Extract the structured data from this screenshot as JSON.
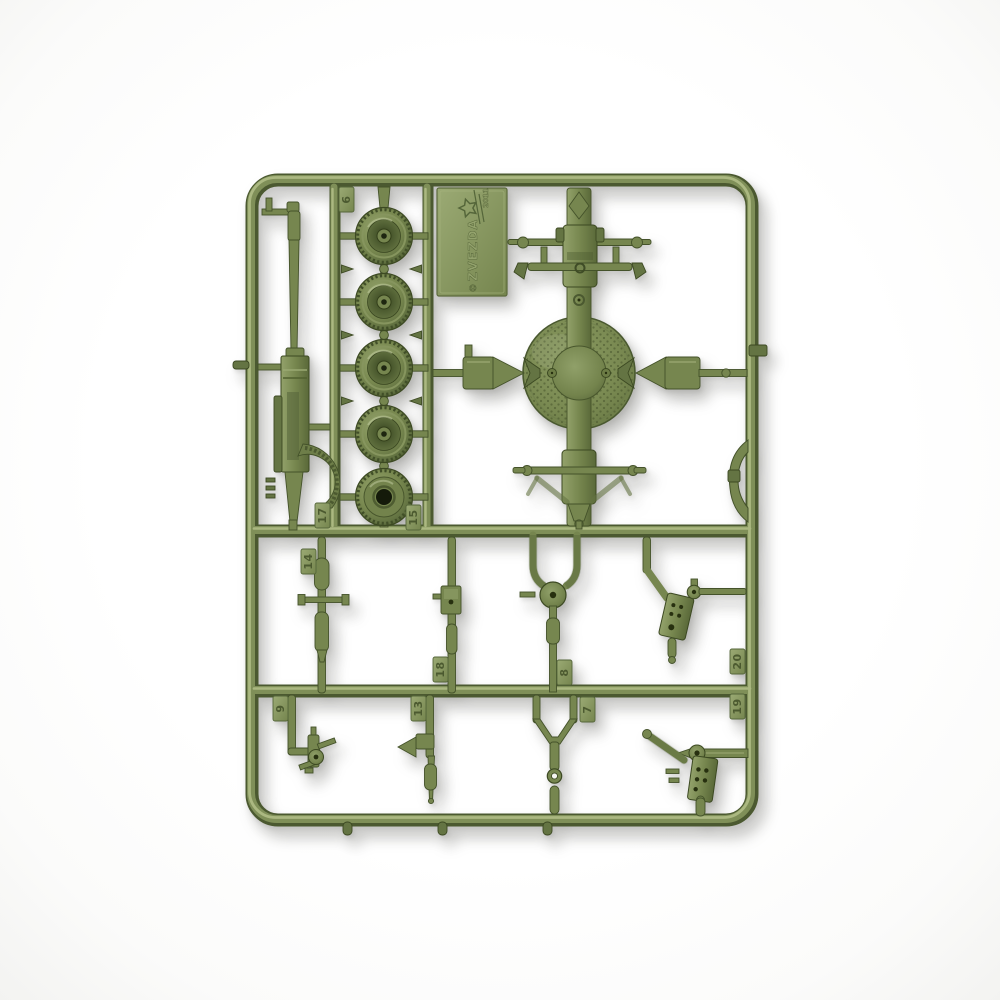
{
  "photo": {
    "type": "product-photo",
    "subject": "olive green plastic model kit sprue with machine-gun parts on white background",
    "background_color": "#ffffff",
    "plastic_color": "#76864f",
    "plastic_highlight": "#abb881",
    "plastic_shadow": "#4b5930",
    "wheel_count": 5
  },
  "plaque": {
    "copyright": "©",
    "brand": "ZVEZDA",
    "year": "2011",
    "logo": "star-icon"
  },
  "part_tags": [
    {
      "number": "6"
    },
    {
      "number": "17"
    },
    {
      "number": "15"
    },
    {
      "number": "14"
    },
    {
      "number": "18"
    },
    {
      "number": "8"
    },
    {
      "number": "20"
    },
    {
      "number": "19"
    },
    {
      "number": "9"
    },
    {
      "number": "13"
    },
    {
      "number": "7"
    }
  ]
}
